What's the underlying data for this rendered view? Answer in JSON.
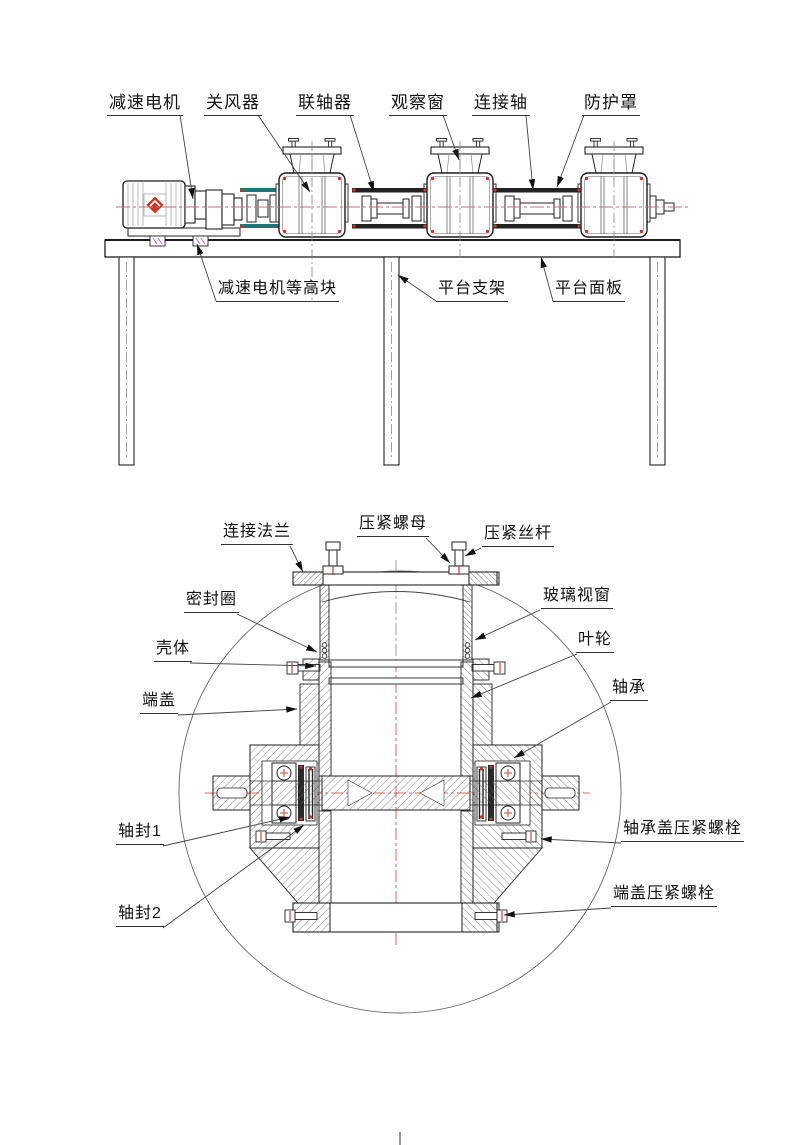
{
  "document": {
    "kind": "mechanical engineering drawing, two views"
  },
  "colors": {
    "line": "#1c1c1c",
    "light_line": "#777777",
    "centerline_red": "#d96b6b",
    "accent_red": "#c0392b",
    "guard_teal": "#1f7575",
    "block_magenta": "#c06bc0",
    "hatch": "#555555"
  },
  "top_view": {
    "labels": [
      {
        "id": "gear-motor",
        "text": "减速电机"
      },
      {
        "id": "rotary-valve",
        "text": "关风器"
      },
      {
        "id": "coupling",
        "text": "联轴器"
      },
      {
        "id": "observation-window",
        "text": "观察窗"
      },
      {
        "id": "connecting-shaft",
        "text": "连接轴"
      },
      {
        "id": "protective-cover",
        "text": "防护罩"
      },
      {
        "id": "motor-leveling-block",
        "text": "减速电机等高块"
      },
      {
        "id": "platform-support",
        "text": "平台支架"
      },
      {
        "id": "platform-panel",
        "text": "平台面板"
      }
    ]
  },
  "section_view": {
    "labels": [
      {
        "id": "connecting-flange",
        "text": "连接法兰"
      },
      {
        "id": "compression-nut",
        "text": "压紧螺母"
      },
      {
        "id": "compression-screw",
        "text": "压紧丝杆"
      },
      {
        "id": "seal-ring",
        "text": "密封圈"
      },
      {
        "id": "glass-window",
        "text": "玻璃视窗"
      },
      {
        "id": "housing",
        "text": "壳体"
      },
      {
        "id": "impeller",
        "text": "叶轮"
      },
      {
        "id": "end-cover",
        "text": "端盖"
      },
      {
        "id": "bearing",
        "text": "轴承"
      },
      {
        "id": "shaft-seal-1",
        "text": "轴封1"
      },
      {
        "id": "shaft-seal-2",
        "text": "轴封2"
      },
      {
        "id": "bearing-cover-bolt",
        "text": "轴承盖压紧螺栓"
      },
      {
        "id": "end-cover-bolt",
        "text": "端盖压紧螺栓"
      }
    ]
  }
}
